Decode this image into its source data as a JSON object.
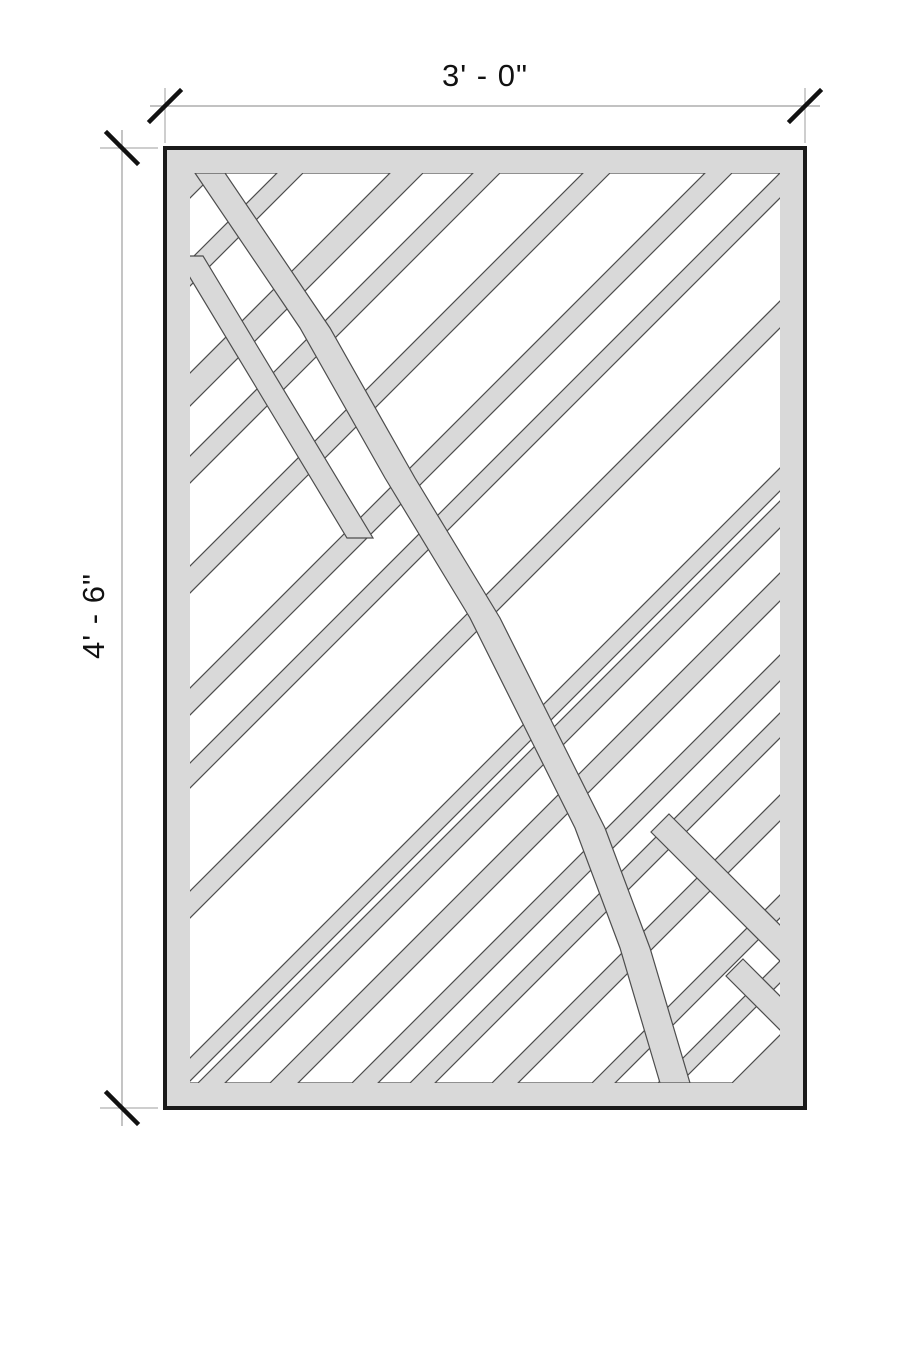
{
  "drawing": {
    "title": "panel-shop-drawing",
    "width_label": "3' - 0\"",
    "height_label": "4' - 6\""
  },
  "colors": {
    "panel_fill": "#d9d9d9",
    "cut_outline": "#4d4d4d",
    "panel_border": "#1a1a1a",
    "dim_line": "#9e9e9e",
    "tick": "#111111",
    "cutout_fill": "#ffffff"
  },
  "panel": {
    "x": 165,
    "y": 148,
    "w": 640,
    "h": 960,
    "inset": 25,
    "border_width": 4,
    "outline_width": 1.2
  },
  "stripes": [
    [
      75,
      137
    ],
    [
      163,
      250
    ],
    [
      283,
      333
    ],
    [
      360,
      443
    ],
    [
      470,
      565
    ],
    [
      592,
      640
    ],
    [
      665,
      768
    ],
    [
      795,
      935
    ],
    [
      958,
      968
    ],
    [
      995,
      1040
    ],
    [
      1068,
      1122
    ],
    [
      1148,
      1180
    ],
    [
      1205,
      1262
    ],
    [
      1288,
      1362
    ],
    [
      1385,
      1428
    ],
    [
      1450,
      1502
    ]
  ],
  "bands": [
    {
      "name": "main-staircase-band",
      "points": [
        [
          30,
          25
        ],
        [
          135,
          180
        ],
        [
          220,
          330
        ],
        [
          305,
          470
        ],
        [
          365,
          590
        ],
        [
          410,
          680
        ],
        [
          455,
          800
        ],
        [
          495,
          935
        ],
        [
          525,
          935
        ],
        [
          485,
          800
        ],
        [
          440,
          680
        ],
        [
          395,
          590
        ],
        [
          335,
          470
        ],
        [
          250,
          330
        ],
        [
          165,
          180
        ],
        [
          60,
          25
        ]
      ]
    },
    {
      "name": "upper-left-band",
      "points": [
        [
          12,
          108
        ],
        [
          182,
          390
        ],
        [
          208,
          390
        ],
        [
          38,
          108
        ]
      ]
    },
    {
      "name": "lower-right-band",
      "points": [
        [
          504,
          666
        ],
        [
          649,
          811
        ],
        [
          631,
          829
        ],
        [
          486,
          684
        ]
      ]
    },
    {
      "name": "corner-band",
      "points": [
        [
          578,
          811
        ],
        [
          653,
          886
        ],
        [
          636,
          903
        ],
        [
          561,
          828
        ]
      ]
    }
  ],
  "dimensions": {
    "top": {
      "line": {
        "x1": 150,
        "y1": 106,
        "x2": 820,
        "y2": 106
      },
      "ext_lines": [
        {
          "x1": 165,
          "y1": 88,
          "x2": 165,
          "y2": 143
        },
        {
          "x1": 805,
          "y1": 88,
          "x2": 805,
          "y2": 143
        }
      ],
      "ticks": [
        {
          "cx": 165,
          "cy": 106,
          "dir": "fwd"
        },
        {
          "cx": 805,
          "cy": 106,
          "dir": "fwd"
        }
      ],
      "label_pos": {
        "x": 485,
        "y": 76
      }
    },
    "left": {
      "line": {
        "x1": 122,
        "y1": 130,
        "x2": 122,
        "y2": 1126
      },
      "ext_lines": [
        {
          "x1": 100,
          "y1": 148,
          "x2": 158,
          "y2": 148
        },
        {
          "x1": 100,
          "y1": 1108,
          "x2": 158,
          "y2": 1108
        }
      ],
      "ticks": [
        {
          "cx": 122,
          "cy": 148,
          "dir": "back"
        },
        {
          "cx": 122,
          "cy": 1108,
          "dir": "back"
        }
      ],
      "label_pos": {
        "x": 94,
        "y": 616
      }
    },
    "tick_half": 15,
    "tick_width": 4.5
  }
}
